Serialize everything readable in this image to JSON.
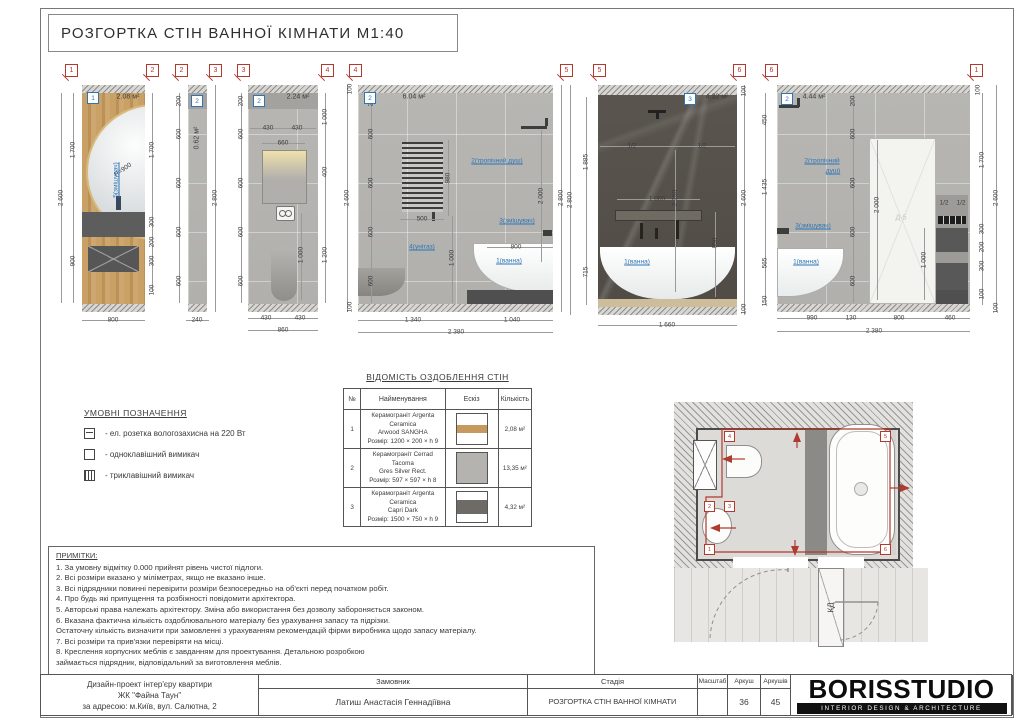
{
  "sheet": {
    "title": "РОЗГОРТКА СТІН ВАННОЇ КІМНАТИ М1:40"
  },
  "colors": {
    "accent_red": "#b03a2e",
    "accent_blue": "#2e75b6",
    "wood": "#c9a066",
    "tile_light": "#b7b6b2",
    "tile_dark": "#57524c"
  },
  "elevations": {
    "markers": [
      [
        "1",
        71
      ],
      [
        "2",
        152
      ],
      [
        "2",
        181
      ],
      [
        "3",
        215
      ],
      [
        "3",
        243
      ],
      [
        "4",
        327
      ],
      [
        "4",
        355
      ],
      [
        "5",
        566
      ],
      [
        "5",
        599
      ],
      [
        "6",
        739
      ],
      [
        "6",
        771
      ],
      [
        "1",
        976
      ]
    ],
    "walls": [
      {
        "no": "1",
        "area": "2.08 м²",
        "bx": 92,
        "by": 97,
        "ax": 128,
        "ay": 97,
        "av": 0
      },
      {
        "no": "2",
        "area": "0.62 м²",
        "bx": 196,
        "by": 100,
        "ax": 197,
        "ay": 138,
        "av": 1
      },
      {
        "no": "2",
        "area": "2.24 м²",
        "bx": 258,
        "by": 100,
        "ax": 298,
        "ay": 97,
        "av": 0
      },
      {
        "no": "2",
        "area": "6.04 м²",
        "bx": 369,
        "by": 97,
        "ax": 414,
        "ay": 97,
        "av": 0
      },
      {
        "no": "3",
        "area": "4.32 м²",
        "bx": 689,
        "by": 98,
        "ax": 717,
        "ay": 97,
        "av": 0
      },
      {
        "no": "2",
        "area": "4.44 м²",
        "bx": 786,
        "by": 98,
        "ax": 814,
        "ay": 97,
        "av": 0
      }
    ],
    "dims": [
      [
        "2 600",
        61,
        198,
        1
      ],
      [
        "1 700",
        73,
        150,
        1
      ],
      [
        "900",
        73,
        261,
        1
      ],
      [
        "1 700",
        152,
        150,
        1
      ],
      [
        "300",
        152,
        222,
        1
      ],
      [
        "200",
        152,
        242,
        1
      ],
      [
        "300",
        152,
        261,
        1
      ],
      [
        "100",
        152,
        290,
        1
      ],
      [
        "800",
        113,
        320,
        0
      ],
      [
        "R=900",
        123,
        170,
        0,
        -35
      ],
      [
        "200",
        179,
        101,
        1
      ],
      [
        "600",
        179,
        134,
        1
      ],
      [
        "600",
        179,
        183,
        1
      ],
      [
        "600",
        179,
        232,
        1
      ],
      [
        "600",
        179,
        281,
        1
      ],
      [
        "2 800",
        215,
        198,
        1
      ],
      [
        "240",
        197,
        320,
        0
      ],
      [
        "200",
        241,
        101,
        1
      ],
      [
        "600",
        241,
        134,
        1
      ],
      [
        "600",
        241,
        183,
        1
      ],
      [
        "600",
        241,
        232,
        1
      ],
      [
        "600",
        241,
        281,
        1
      ],
      [
        "430",
        268,
        128,
        0
      ],
      [
        "430",
        297,
        128,
        0
      ],
      [
        "660",
        283,
        143,
        0
      ],
      [
        "1 000",
        325,
        117,
        1
      ],
      [
        "400",
        325,
        172,
        1
      ],
      [
        "1 200",
        325,
        255,
        1
      ],
      [
        "1 000",
        301,
        255,
        1
      ],
      [
        "430",
        266,
        318,
        0
      ],
      [
        "430",
        300,
        318,
        0
      ],
      [
        "860",
        283,
        330,
        0
      ],
      [
        "100",
        350,
        89,
        1
      ],
      [
        "2 600",
        347,
        198,
        1
      ],
      [
        "100",
        350,
        307,
        1
      ],
      [
        "200",
        371,
        101,
        1
      ],
      [
        "600",
        371,
        134,
        1
      ],
      [
        "600",
        371,
        183,
        1
      ],
      [
        "600",
        371,
        232,
        1
      ],
      [
        "600",
        371,
        281,
        1
      ],
      [
        "500",
        422,
        219,
        0
      ],
      [
        "980",
        448,
        178,
        1
      ],
      [
        "1 000",
        452,
        258,
        1
      ],
      [
        "800",
        516,
        247,
        0
      ],
      [
        "2 000",
        541,
        196,
        1
      ],
      [
        "2 800",
        561,
        198,
        1
      ],
      [
        "1 340",
        413,
        320,
        0
      ],
      [
        "1 040",
        512,
        320,
        0
      ],
      [
        "2 380",
        456,
        332,
        0
      ],
      [
        "2 800",
        570,
        200,
        1
      ],
      [
        "1 885",
        586,
        162,
        1
      ],
      [
        "715",
        586,
        272,
        1
      ],
      [
        "1/2",
        632,
        146,
        0
      ],
      [
        "1/2",
        702,
        146,
        0
      ],
      [
        "2 150",
        675,
        198,
        1
      ],
      [
        "1 000",
        657,
        199,
        0
      ],
      [
        "950",
        715,
        243,
        1
      ],
      [
        "100",
        744,
        91,
        1
      ],
      [
        "2 600",
        744,
        198,
        1
      ],
      [
        "100",
        744,
        309,
        1
      ],
      [
        "1 660",
        667,
        325,
        0
      ],
      [
        "450",
        765,
        120,
        1
      ],
      [
        "1 435",
        765,
        187,
        1
      ],
      [
        "565",
        765,
        263,
        1
      ],
      [
        "150",
        765,
        301,
        1
      ],
      [
        "200",
        853,
        101,
        1
      ],
      [
        "600",
        853,
        134,
        1
      ],
      [
        "600",
        853,
        183,
        1
      ],
      [
        "600",
        853,
        232,
        1
      ],
      [
        "600",
        853,
        281,
        1
      ],
      [
        "2 000",
        877,
        205,
        1
      ],
      [
        "1 000",
        924,
        260,
        1
      ],
      [
        "1/2",
        944,
        203,
        0
      ],
      [
        "1/2",
        961,
        203,
        0
      ],
      [
        "100",
        978,
        90,
        1
      ],
      [
        "1 700",
        982,
        160,
        1
      ],
      [
        "2 600",
        996,
        198,
        1
      ],
      [
        "300",
        982,
        229,
        1
      ],
      [
        "200",
        982,
        247,
        1
      ],
      [
        "300",
        982,
        266,
        1
      ],
      [
        "100",
        982,
        294,
        1
      ],
      [
        "100",
        996,
        308,
        1
      ],
      [
        "990",
        812,
        318,
        0
      ],
      [
        "130",
        851,
        318,
        0
      ],
      [
        "800",
        899,
        318,
        0
      ],
      [
        "460",
        950,
        318,
        0
      ],
      [
        "2 380",
        874,
        331,
        0
      ]
    ],
    "labels": [
      [
        "5(змішувач)",
        116,
        180,
        1
      ],
      [
        "2(тропічний душ)",
        497,
        161,
        0
      ],
      [
        "3(змішувач)",
        517,
        221,
        0
      ],
      [
        "1(ванна)",
        509,
        261,
        0
      ],
      [
        "4(унітаз)",
        422,
        247,
        0
      ],
      [
        "1(ванна)",
        637,
        262,
        0
      ],
      [
        "2(тропічний",
        822,
        161,
        0
      ],
      [
        "душ)",
        833,
        171,
        0
      ],
      [
        "3(змішувач)",
        813,
        226,
        0
      ],
      [
        "1(ванна)",
        806,
        262,
        0
      ]
    ],
    "vlines": [
      [
        61,
        93,
        303
      ],
      [
        73,
        93,
        303
      ],
      [
        152,
        93,
        292
      ],
      [
        179,
        93,
        303
      ],
      [
        215,
        85,
        312
      ],
      [
        241,
        93,
        303
      ],
      [
        325,
        93,
        303
      ],
      [
        301,
        213,
        300
      ],
      [
        347,
        85,
        312
      ],
      [
        371,
        93,
        303
      ],
      [
        448,
        140,
        216
      ],
      [
        452,
        216,
        303
      ],
      [
        541,
        130,
        262
      ],
      [
        561,
        85,
        312
      ],
      [
        570,
        85,
        315
      ],
      [
        586,
        97,
        305
      ],
      [
        675,
        150,
        292
      ],
      [
        715,
        212,
        297
      ],
      [
        744,
        85,
        315
      ],
      [
        765,
        93,
        305
      ],
      [
        853,
        93,
        303
      ],
      [
        877,
        140,
        300
      ],
      [
        924,
        228,
        300
      ],
      [
        982,
        93,
        305
      ],
      [
        996,
        85,
        312
      ]
    ],
    "hlines": [
      [
        320,
        82,
        145
      ],
      [
        320,
        186,
        209
      ],
      [
        128,
        250,
        316
      ],
      [
        143,
        262,
        305
      ],
      [
        318,
        248,
        318
      ],
      [
        330,
        248,
        318
      ],
      [
        219,
        400,
        444
      ],
      [
        247,
        487,
        553
      ],
      [
        320,
        358,
        553
      ],
      [
        332,
        358,
        553
      ],
      [
        146,
        600,
        735
      ],
      [
        199,
        617,
        700
      ],
      [
        325,
        598,
        737
      ],
      [
        203,
        936,
        968
      ],
      [
        318,
        777,
        970
      ],
      [
        331,
        777,
        970
      ]
    ],
    "extra": {
      "door_label": "Д-5"
    }
  },
  "legend": {
    "title": "УМОВНІ ПОЗНАЧЕННЯ",
    "items": [
      {
        "icon": "socket-icon",
        "text": "- ел. розетка вологозахисна на 220 Вт"
      },
      {
        "icon": "switch-one-icon",
        "text": "- одноклавішний вимикач"
      },
      {
        "icon": "switch-three-icon",
        "text": "- триклавішний вимикач"
      }
    ]
  },
  "finish_table": {
    "title": "ВІДОМІСТЬ ОЗДОБЛЕННЯ СТІН",
    "headers": [
      "№",
      "Найменування",
      "Ескіз",
      "Кількість"
    ],
    "rows": [
      {
        "no": "1",
        "name1": "Керамограніт Argenta Ceramica",
        "name2": "Arwood SANGHA",
        "size": "Розмір: 1200 × 200 × h 9",
        "qty": "2,08 м²",
        "swatch": "wood-plank"
      },
      {
        "no": "2",
        "name1": "Керамограніт Cerrad Tacoma",
        "name2": "Gres Silver Rect.",
        "size": "Розмір: 597 × 597 × h 8",
        "qty": "13,35 м²",
        "swatch": "silver-tile"
      },
      {
        "no": "3",
        "name1": "Керамограніт Argenta Ceramica",
        "name2": "Capri Dark",
        "size": "Розмір: 1500 × 750 × h 9",
        "qty": "4,32 м²",
        "swatch": "dark-tile"
      }
    ]
  },
  "notes": {
    "title": "ПРИМІТКИ:",
    "lines": [
      "1. За умовну відмітку 0.000 прийнят рівень чистої підлоги.",
      "2. Всі розміри вказано у міліметрах, якщо не вказано інше.",
      "3. Всі підрядники повинні перевірити розміри безпосередньо на об'єкті перед початком робіт.",
      "4. Про будь які припущення та розбіжності повідомити архітектора.",
      "5. Авторські права належать архітектору. Зміна або використання без дозволу забороняється законом.",
      "6. Вказана фактична кількість оздоблювального матеріалу без урахування запасу та підрізки.",
      "Остаточну кількість визначити при замовленні з урахуванням рекомендацій фірми виробника щодо запасу матеріалу.",
      "7. Всі розміри та прив'язки перевіряти на місці.",
      "8. Креслення корпусних меблів є завданням для проектування. Детальною розробкою",
      "займається підрядник, відповідальний за виготовлення меблів."
    ]
  },
  "plan": {
    "door_label": "КД",
    "markers": [
      [
        "4",
        68,
        45
      ],
      [
        "5",
        224,
        45
      ],
      [
        "6",
        224,
        158
      ],
      [
        "1",
        48,
        158
      ],
      [
        "2",
        48,
        115
      ],
      [
        "3",
        68,
        115
      ]
    ]
  },
  "titleblock": {
    "project_line1": "Дизайн-проект інтер'єру квартири",
    "project_line2": "ЖК \"Файна Таун\"",
    "project_line3": "за адресою: м.Київ, вул. Салютна, 2",
    "client_label": "Замовник",
    "client_value": "Латиш Анастасія Геннадіївна",
    "stage_label": "Стадія",
    "stage_value": "РОЗГОРТКА СТІН ВАННОЇ КІМНАТИ",
    "scale_label": "Масштаб",
    "scale_value": "",
    "sheet_label": "Аркуш",
    "sheet_value": "36",
    "sheets_label": "Аркушів",
    "sheets_value": "45",
    "logo_text": "BORISSTUDIO",
    "logo_tagline": "INTERIOR DESIGN & ARCHITECTURE"
  }
}
